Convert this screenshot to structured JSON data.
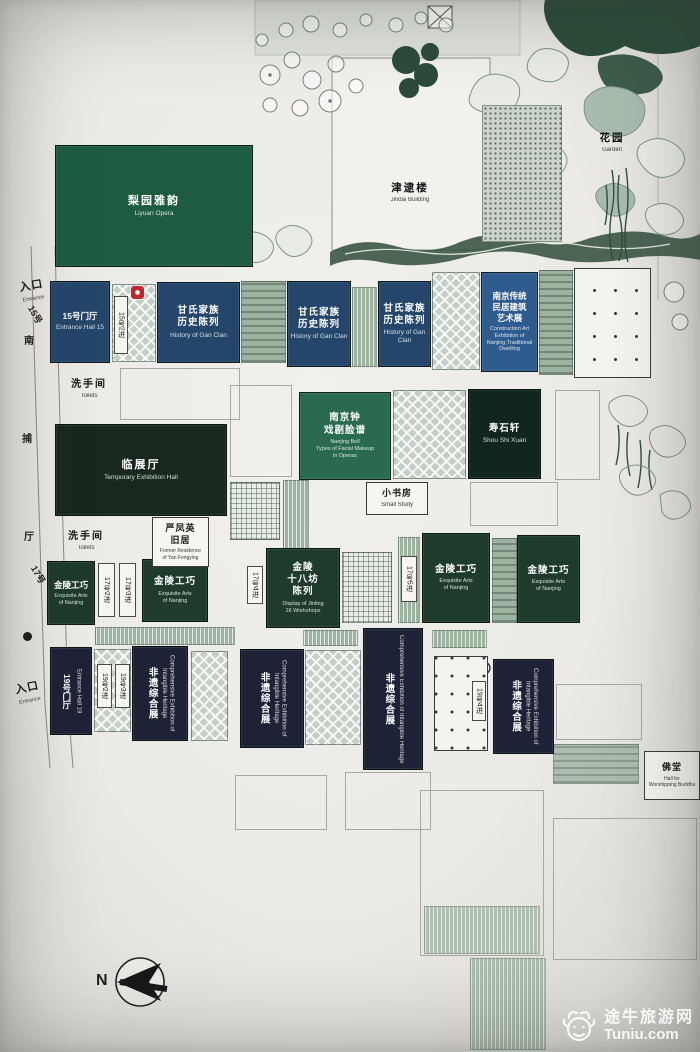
{
  "palette": {
    "navy": "#24466b",
    "bright_blue": "#2e5c8f",
    "dark_green": "#1d5c41",
    "mid_green": "#2a6b50",
    "deep_green": "#18281f",
    "navy_black": "#1d2236",
    "courtyard": "#c5cfc6",
    "marker_red": "#c0272d",
    "paper": "#efeeea"
  },
  "b": {
    "liyuan": {
      "zh": "梨园雅韵",
      "en": "Liyuan Opera"
    },
    "jindai": {
      "zh": "津逮楼",
      "en": "Jindai Building"
    },
    "garden": {
      "zh": "花园",
      "en": "Garden"
    },
    "hall15": {
      "zh": "15号门厅",
      "en": "Entrance Hall 15"
    },
    "gan": {
      "zh": "甘氏家族\n历史陈列",
      "en": "History of Gan Clan"
    },
    "dwelling": {
      "zh": "南京传统\n民居建筑\n艺术展",
      "en": "Construction Art\nExhibition of\nNanjing Traditional\nDwelling"
    },
    "toilets": {
      "zh": "洗手间",
      "en": "Toilets"
    },
    "linzhan": {
      "zh": "临展厅",
      "en": "Temporary Exhibition Hall"
    },
    "bell": {
      "zh": "南京钟\n戏剧脸谱",
      "en": "Nanjing Bell\nTypes of Facial Makeup\nin Operas"
    },
    "shoushi": {
      "zh": "寿石轩",
      "en": "Shou Shi Xuan"
    },
    "study": {
      "zh": "小书房",
      "en": "Small Study"
    },
    "yan": {
      "zh": "严凤英\n旧居",
      "en": "Former Residence\nof Yan Fengying"
    },
    "jinling": {
      "zh": "金陵工巧",
      "en": "Exquisite Arts\nof Nanjing"
    },
    "shibafang": {
      "zh": "金陵\n十八坊\n陈列",
      "en": "Display of Jinling\n18 Workshops"
    },
    "hall19": {
      "zh": "19号门厅",
      "en": "Entrance Hall 19"
    },
    "feiyi": {
      "zh": "非遗综合展",
      "en": "Comprehensive Exhibition of Intangible Heritage"
    },
    "fotang": {
      "zh": "佛堂",
      "en": "Hall for\nWorshipping Buddha"
    }
  },
  "markers": {
    "m15": "15号2进",
    "m17a": "17号2进",
    "m17b": "17号3进",
    "m17c": "17号4进",
    "m17d": "17号5进",
    "m19a": "19号2进",
    "m19b": "19号3进",
    "m19c": "19号4进"
  },
  "street": {
    "entrance": "入口",
    "entrance_en": "Entrance",
    "no15": "15号",
    "nan": "南",
    "bu": "捕",
    "ting": "厅",
    "no17": "17号"
  },
  "compass": {
    "label": "N"
  },
  "watermark": {
    "zh": "途牛旅游网",
    "en": "Tuniu.com"
  }
}
